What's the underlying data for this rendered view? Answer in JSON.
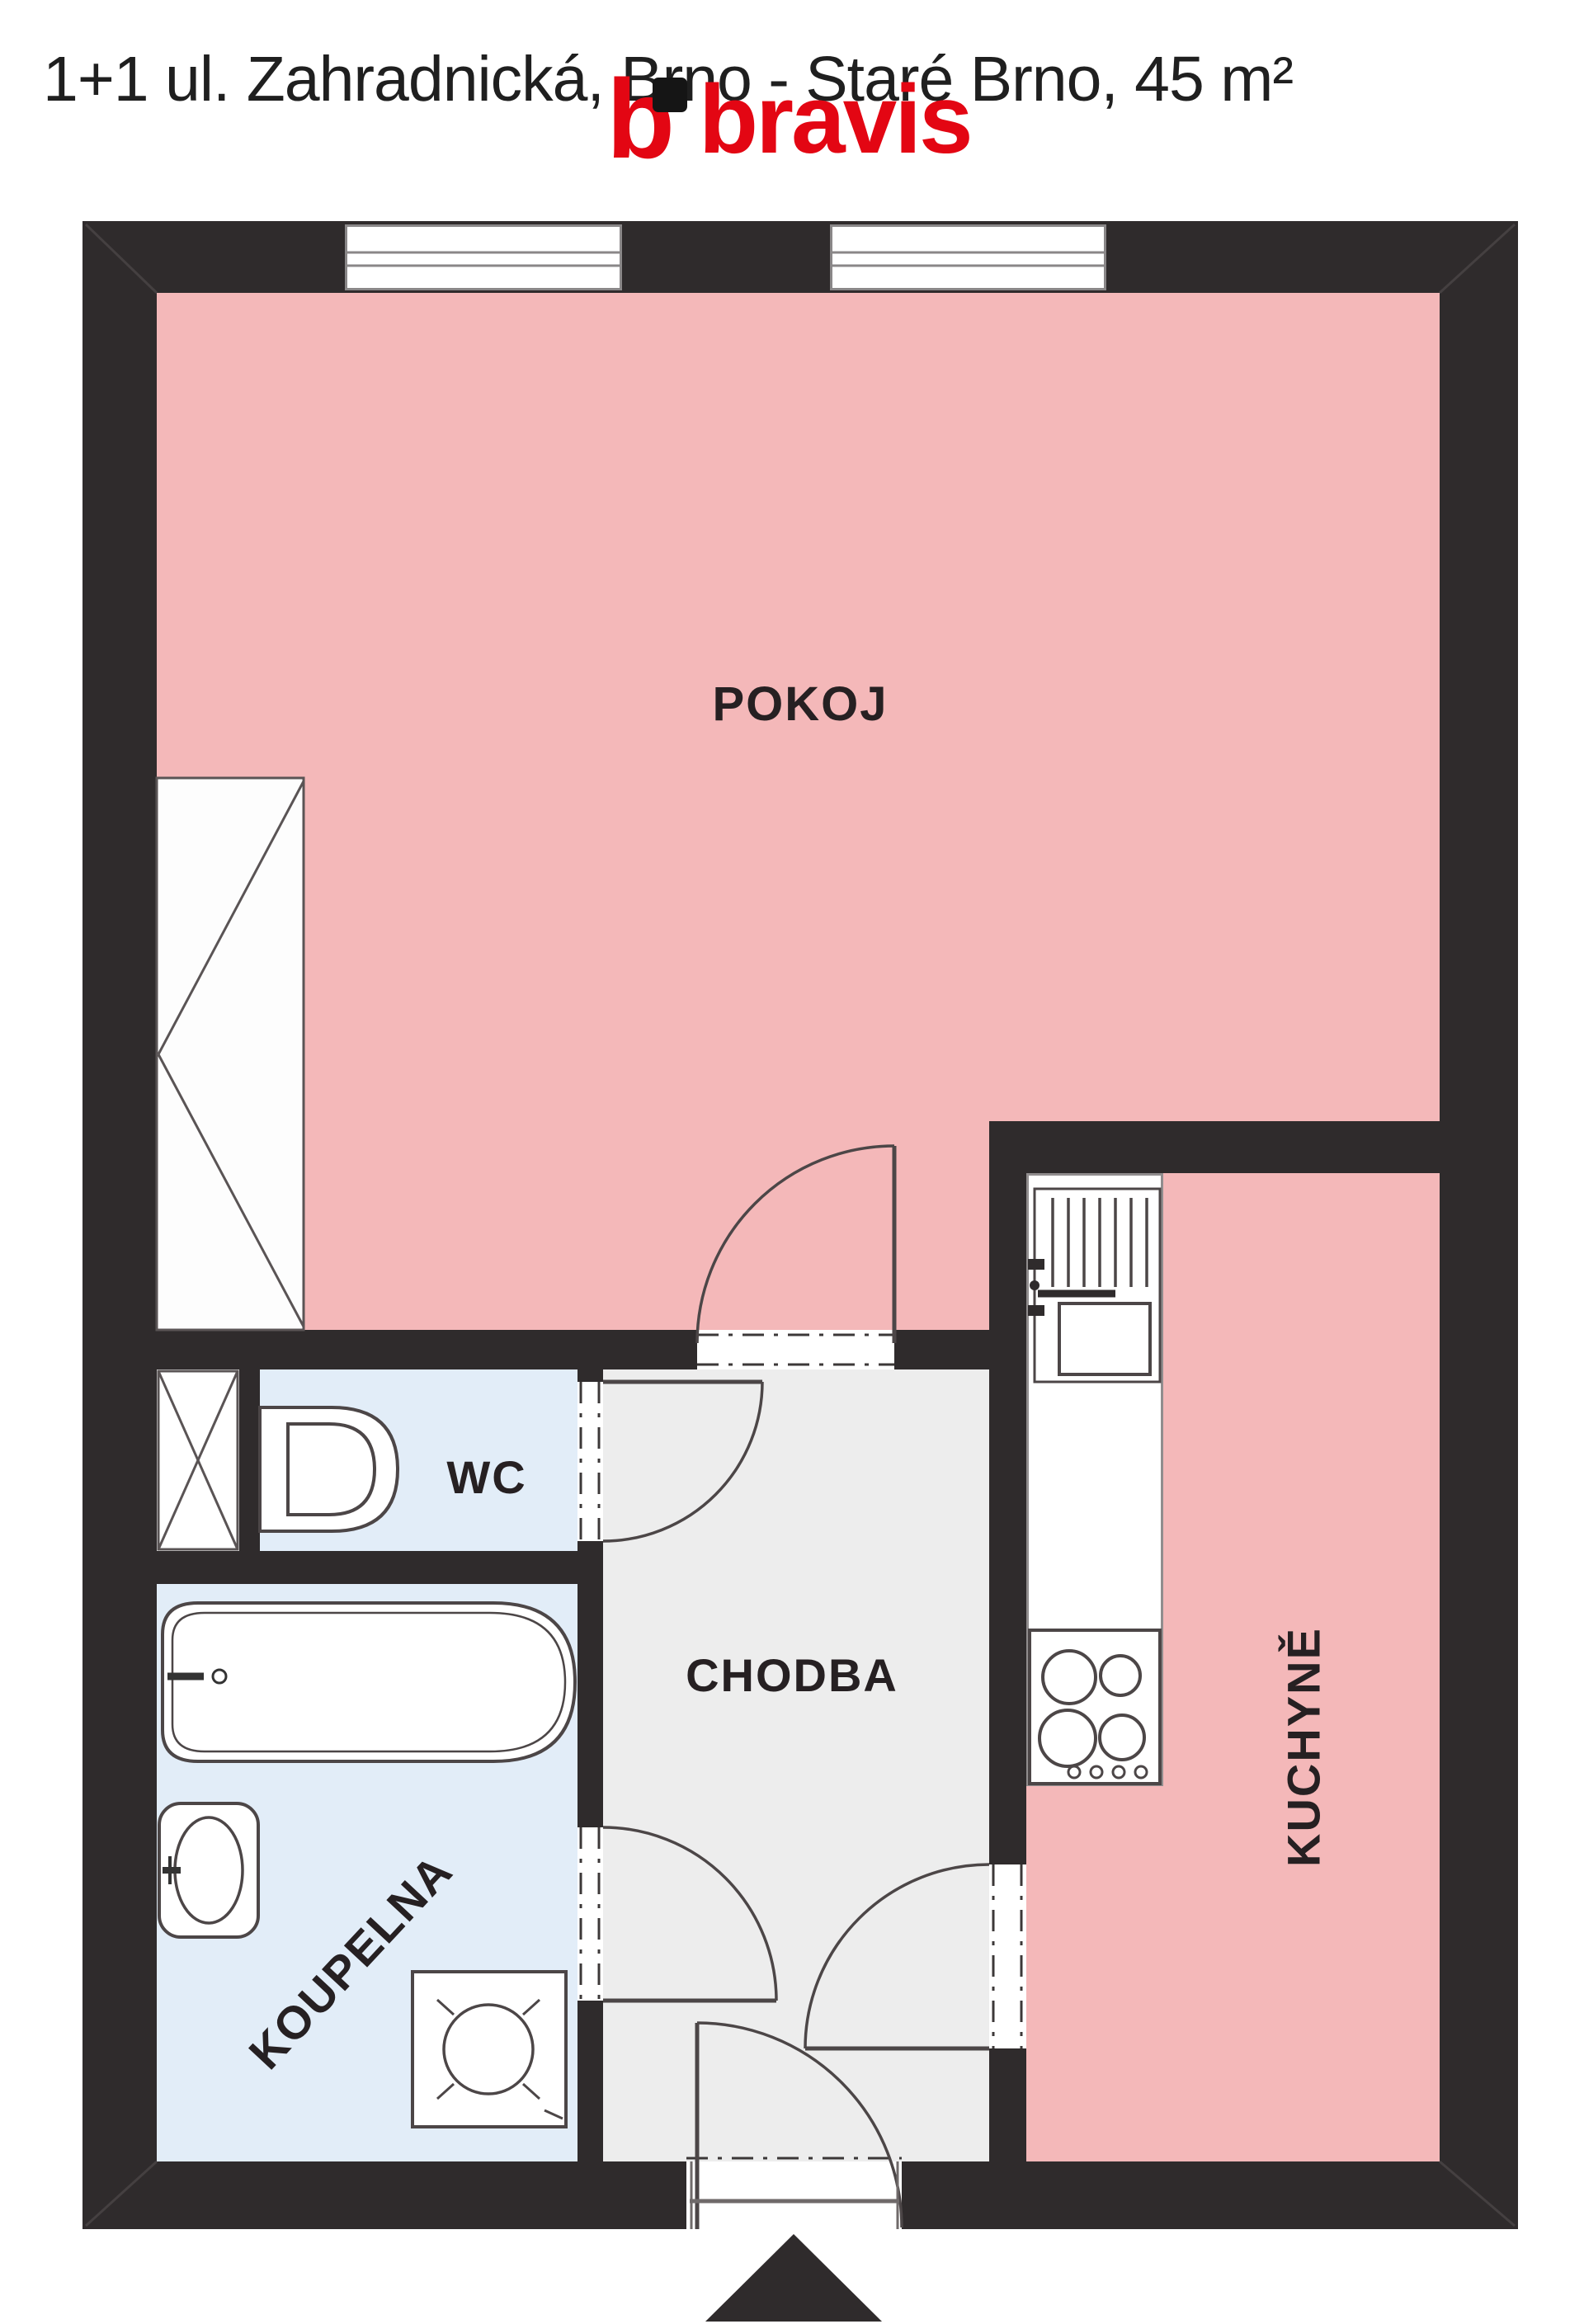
{
  "header": {
    "title": "1+1 ul. Zahradnická, Brno - Staré Brno, 45 m²",
    "logo": {
      "word": "bravis",
      "mark_letter": "b",
      "red": "#e30613",
      "black": "#151515"
    }
  },
  "floorplan": {
    "rooms": {
      "pokoj": {
        "label": "POKOJ",
        "color": "#f4b8b9"
      },
      "kuchyne": {
        "label": "KUCHYNĚ",
        "color": "#f4b8b9"
      },
      "chodba": {
        "label": "CHODBA",
        "color": "#ededed"
      },
      "koupelna": {
        "label": "KOUPELNA",
        "color": "#e2edf8"
      },
      "wc": {
        "label": "WC",
        "color": "#e2edf8"
      }
    },
    "wall_color": "#2f2b2c",
    "fixtures": [
      "window",
      "wardrobe",
      "ventilation-shaft",
      "toilet",
      "bathtub",
      "washbasin",
      "washing-machine",
      "kitchen-sink",
      "stove",
      "door-swing",
      "entrance-arrow"
    ]
  }
}
